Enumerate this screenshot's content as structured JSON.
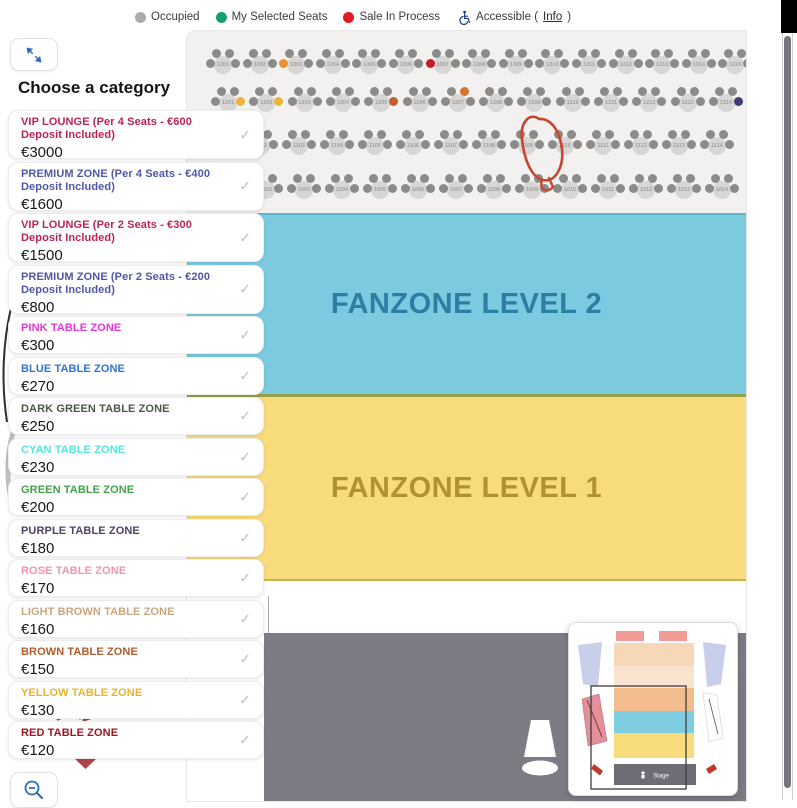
{
  "legend": {
    "items": [
      {
        "label": "Occupied",
        "color": "#ababab"
      },
      {
        "label": "My Selected Seats",
        "color": "#14a06c"
      },
      {
        "label": "Sale In Process",
        "color": "#e11b22"
      }
    ],
    "accessible": {
      "prefix": "Accessible (",
      "link": "Info",
      "suffix": ")",
      "icon_color": "#1d3f8f"
    }
  },
  "sidebar": {
    "heading": "Choose a category",
    "check_glyph": "✓",
    "categories": [
      {
        "name": "VIP LOUNGE (Per 4 Seats - €600 Deposit Included)",
        "price": "€3000",
        "color": "#bc2457",
        "two_line": true
      },
      {
        "name": "PREMIUM ZONE (Per 4 Seats - €400 Deposit Included)",
        "price": "€1600",
        "color": "#5156a8",
        "two_line": true
      },
      {
        "name": "VIP LOUNGE (Per 2 Seats - €300 Deposit Included)",
        "price": "€1500",
        "color": "#bc2457",
        "two_line": true
      },
      {
        "name": "PREMIUM ZONE (Per 2 Seats - €200 Deposit Included)",
        "price": "€800",
        "color": "#5156a8",
        "two_line": true
      },
      {
        "name": "PINK TABLE ZONE",
        "price": "€300",
        "color": "#e038d8",
        "two_line": false
      },
      {
        "name": "BLUE TABLE ZONE",
        "price": "€270",
        "color": "#3273d3",
        "two_line": false
      },
      {
        "name": "DARK GREEN TABLE ZONE",
        "price": "€250",
        "color": "#4c5748",
        "two_line": false
      },
      {
        "name": "CYAN TABLE ZONE",
        "price": "€230",
        "color": "#55e6de",
        "two_line": false
      },
      {
        "name": "GREEN TABLE ZONE",
        "price": "€200",
        "color": "#41a34c",
        "two_line": false
      },
      {
        "name": "PURPLE TABLE ZONE",
        "price": "€180",
        "color": "#4e4168",
        "two_line": false
      },
      {
        "name": "ROSE TABLE ZONE",
        "price": "€170",
        "color": "#f095ae",
        "two_line": false
      },
      {
        "name": "LIGHT BROWN TABLE ZONE",
        "price": "€160",
        "color": "#cba67c",
        "two_line": false
      },
      {
        "name": "BROWN TABLE ZONE",
        "price": "€150",
        "color": "#b05c2b",
        "two_line": false
      },
      {
        "name": "YELLOW TABLE ZONE",
        "price": "€130",
        "color": "#eab32b",
        "two_line": false
      },
      {
        "name": "RED TABLE ZONE",
        "price": "€120",
        "color": "#9c1722",
        "two_line": false
      }
    ]
  },
  "map": {
    "zones": [
      {
        "label": "FANZONE LEVEL 2",
        "bg": "#7ccadf",
        "text_color": "#2b7fa3"
      },
      {
        "label": "FANZONE LEVEL 1",
        "bg": "#f8db7b",
        "text_color": "#b2922e"
      }
    ],
    "stage_label": "Stage",
    "stage_bg": "#7c7c84",
    "seat_rows": [
      {
        "label_start": 1301,
        "count": 15,
        "x": 36,
        "y": 32,
        "dx": 36.6
      },
      {
        "label_start": 1201,
        "count": 14,
        "x": 41,
        "y": 70,
        "dx": 38.3
      },
      {
        "label_start": 1101,
        "count": 14,
        "x": 36,
        "y": 113,
        "dx": 38
      },
      {
        "label_start": 1001,
        "count": 14,
        "x": 41,
        "y": 157,
        "dx": 38
      }
    ],
    "colored_seats": [
      {
        "row": 0,
        "table": 3,
        "seat": "l",
        "color": "#e8922e"
      },
      {
        "row": 0,
        "table": 7,
        "seat": "l",
        "color": "#c41e28"
      },
      {
        "row": 1,
        "table": 1,
        "seat": "r",
        "color": "#eab53a"
      },
      {
        "row": 1,
        "table": 2,
        "seat": "r",
        "color": "#eab53a"
      },
      {
        "row": 1,
        "table": 5,
        "seat": "r",
        "color": "#bf5f2e"
      },
      {
        "row": 1,
        "table": 7,
        "seat": "tr",
        "color": "#d2742f"
      },
      {
        "row": 1,
        "table": 14,
        "seat": "r",
        "color": "#3f3d75"
      }
    ]
  },
  "minimap": {
    "stage_label": "Stage"
  }
}
